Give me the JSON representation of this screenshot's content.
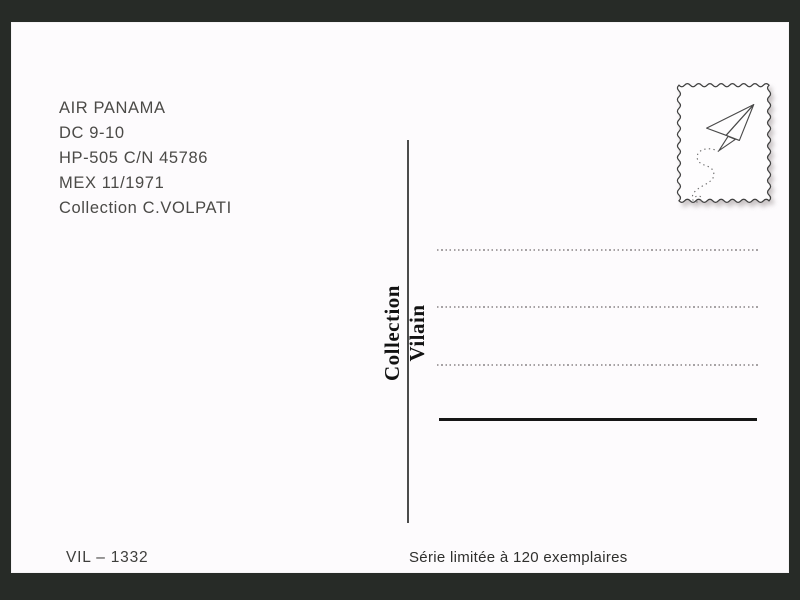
{
  "postcard": {
    "info_lines": [
      "AIR PANAMA",
      "DC 9-10",
      "HP-505 C/N 45786",
      "MEX 11/1971",
      "Collection C.VOLPATI"
    ],
    "publisher_vertical": "Collection Vilain",
    "catalog_number": "VIL – 1332",
    "edition_note": "Série limitée à 120 exemplaires",
    "address_line_count": 3
  },
  "stamp": {
    "icon": "paper-plane-icon",
    "border_style": "wavy-scalloped"
  },
  "colors": {
    "frame": "#272b27",
    "card": "#fdfbfd",
    "info_text": "#4b4a47",
    "publisher_text": "#121212",
    "dotted_line": "#a6a2a4",
    "signature_line": "#161616",
    "stamp_outline": "#3f3f3f"
  }
}
